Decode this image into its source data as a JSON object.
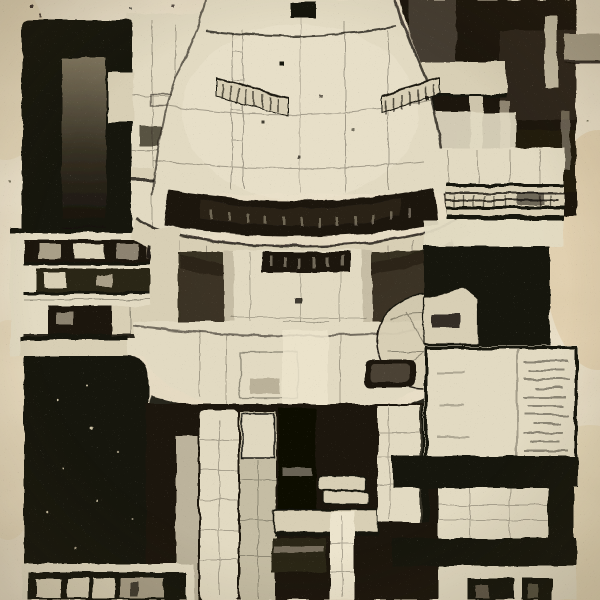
{
  "artwork": {
    "type": "monochrome-architectural-etching",
    "description": "Black ink etching on aged cream paper depicting a symmetric brutalist retro-futuristic tower: a large domed turret with balcony railings, a dark recessed gallery band, a protruding lip ring, a mid cylinder, a wide saucer bowl with a circular disc, and a columned undercarriage; flanked by black window blocks, cross-section floor strips and stepped concrete masses; blank paper margins on left and right edges",
    "regions": [
      "dome-turret",
      "gallery-band",
      "lip-ring",
      "mid-cylinder",
      "saucer-bowl",
      "disc-wheel",
      "legs-undercarriage",
      "left-ink-block",
      "left-floors-section",
      "left-void-mass",
      "left-window-strip",
      "right-dark-mass",
      "striped-ledge",
      "right-black-square",
      "right-text-panel",
      "right-lower-stack",
      "right-window-strip",
      "paper-margins"
    ]
  },
  "palette": {
    "paper": "#e9dfc8",
    "paperShade": "#e0d0ac",
    "stain": "#dcc49a",
    "light": "#e2dac2",
    "light2": "#d8cfb5",
    "highlight": "#ece4cd",
    "gray": "#a99f88",
    "midGray": "#6e6453",
    "dark": "#1c1711",
    "dark2": "#2b2518",
    "ink": "#17130c",
    "deep": "#0c0a05"
  }
}
